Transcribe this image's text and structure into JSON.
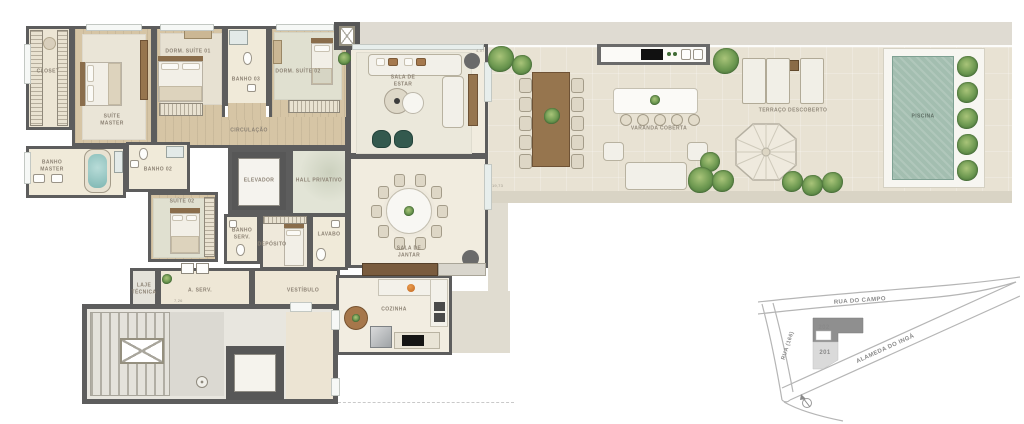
{
  "rooms": {
    "closet": "CLOSET",
    "suite_master": "SUÍTE\nMASTER",
    "dorm_suite_01": "DORM. SUÍTE 01",
    "banho_03": "BANHO 03",
    "dorm_suite_02": "DORM. SUÍTE 02",
    "circulacao": "CIRCULAÇÃO",
    "banho_master": "BANHO\nMASTER",
    "banho_02": "BANHO 02",
    "suite_02": "SUÍTE 02",
    "elevador": "ELEVADOR",
    "hall_privativo": "HALL PRIVATIVO",
    "banho_serv": "BANHO\nSERV.",
    "deposito": "DEPÓSITO",
    "lavabo": "LAVABO",
    "vestibulo": "VESTÍBULO",
    "a_serv": "A. SERV.",
    "laje_tecnica": "LAJE\nTÉCNICA",
    "cozinha": "COZINHA",
    "sala_de_estar": "SALA DE\nESTAR",
    "sala_de_jantar": "SALA DE\nJANTAR",
    "varanda_coberta": "VARANDA COBERTA",
    "terraco_descoberto": "TERRAÇO DESCOBERTO",
    "piscina": "PISCINA"
  },
  "dimensions": {
    "sala_estar_width": "4,07",
    "varanda_length": "19,73",
    "servico_width": "7,26"
  },
  "map": {
    "street_top": "RUA DO CAMPO",
    "street_diagonal": "ALAMEDA DO INGÁ",
    "street_left": "RUA (166)",
    "unit_highlighted": "202",
    "unit_adjacent": "201"
  },
  "colors": {
    "wall": "#5d5d5d",
    "wood_floor": "#d6c5a5",
    "terrace_floor": "#e8e2d3",
    "pool_water": "#a3beb0",
    "plant_green": "#5f8a49",
    "armchair_green": "#33594e",
    "furniture_wood": "#96754e"
  }
}
